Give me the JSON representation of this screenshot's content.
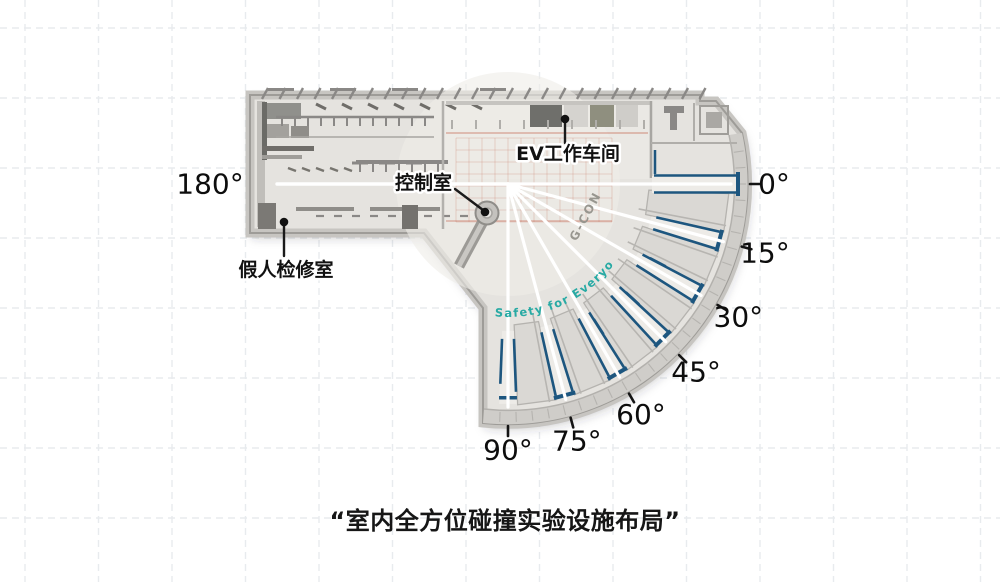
{
  "caption": "“室内全方位碰撞实验设施布局”",
  "floorplan": {
    "center": {
      "x": 508,
      "y": 184
    },
    "angle_labels": [
      {
        "angle": 0,
        "text": "0°"
      },
      {
        "angle": 15,
        "text": "15°"
      },
      {
        "angle": 30,
        "text": "30°"
      },
      {
        "angle": 45,
        "text": "45°"
      },
      {
        "angle": 60,
        "text": "60°"
      },
      {
        "angle": 75,
        "text": "75°"
      },
      {
        "angle": 90,
        "text": "90°"
      },
      {
        "angle": 180,
        "text": "180°"
      }
    ],
    "room_labels": {
      "control_room": "控制室",
      "ev_workshop": "EV工作车间",
      "dummy_maintenance_room": "假人检修室"
    },
    "branding": {
      "arc_text": "Safety for Everyone",
      "logo_text": "G-CON"
    },
    "colors": {
      "barrier_blue": "#1d567f",
      "arc_text_teal": "#28aaa4",
      "runway_white": "#ffffff",
      "grid_dash": "#e8ebee"
    }
  }
}
